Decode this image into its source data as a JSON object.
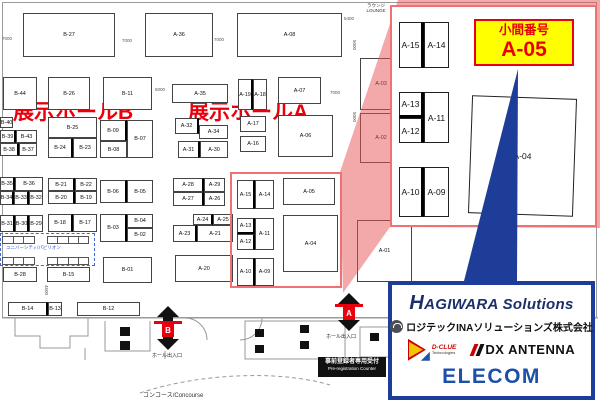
{
  "map": {
    "hall_b_label": "展示ホールB",
    "hall_a_label": "展示ホールA",
    "lounge_line1": "ラウンジ",
    "lounge_line2": "LOUNGE",
    "concourse_label": "コンコース/Concourse",
    "prereg_line1": "事前登録者専用受付",
    "prereg_line2": "Pre-registration Counter",
    "gate_labels": [
      {
        "text": "ホール出入口",
        "x": 152,
        "y": 352
      },
      {
        "text": "ホール出入口",
        "x": 326,
        "y": 333
      }
    ],
    "entrances": [
      {
        "label": "B",
        "x": 157,
        "y": 306,
        "h": 44,
        "bar_y": 321,
        "box_y": 324
      },
      {
        "label": "A",
        "x": 338,
        "y": 293,
        "h": 38,
        "bar_y": 304,
        "box_y": 307
      }
    ],
    "pavilion": {
      "label": "ユニバーシティ/パビリオン",
      "box": {
        "x": 0,
        "y": 233,
        "w": 95,
        "h": 33
      },
      "label_pos": {
        "x": 6,
        "y": 245
      },
      "cell_groups": [
        {
          "x": 2,
          "y": 236,
          "w": 33,
          "h": 8,
          "cells": 3
        },
        {
          "x": 47,
          "y": 236,
          "w": 42,
          "h": 8,
          "cells": 4
        },
        {
          "x": 2,
          "y": 257,
          "w": 33,
          "h": 8,
          "cells": 3
        },
        {
          "x": 47,
          "y": 257,
          "w": 42,
          "h": 8,
          "cells": 4
        }
      ]
    },
    "dimensions": [
      {
        "text": "7000",
        "x": 2,
        "y": 36
      },
      {
        "text": "7000",
        "x": 122,
        "y": 38
      },
      {
        "text": "7000",
        "x": 214,
        "y": 37
      },
      {
        "text": "5400",
        "x": 344,
        "y": 16
      },
      {
        "text": "5000",
        "x": 155,
        "y": 87
      },
      {
        "text": "7000",
        "x": 330,
        "y": 90
      },
      {
        "text": "5000",
        "x": 352,
        "y": 40,
        "v": 1
      },
      {
        "text": "5000",
        "x": 352,
        "y": 112,
        "v": 1
      },
      {
        "text": "4500",
        "x": 44,
        "y": 285,
        "v": 1
      }
    ],
    "booths": [
      {
        "label": "B-27",
        "x": 23,
        "y": 13,
        "w": 92,
        "h": 44
      },
      {
        "label": "A-36",
        "x": 145,
        "y": 13,
        "w": 68,
        "h": 44
      },
      {
        "label": "A-08",
        "x": 237,
        "y": 13,
        "w": 105,
        "h": 44
      },
      {
        "label": "B-44",
        "x": 3,
        "y": 77,
        "w": 34,
        "h": 33
      },
      {
        "label": "B-26",
        "x": 48,
        "y": 77,
        "w": 42,
        "h": 33
      },
      {
        "label": "B-11",
        "x": 103,
        "y": 77,
        "w": 49,
        "h": 33
      },
      {
        "label": "A-35",
        "x": 172,
        "y": 84,
        "w": 56,
        "h": 19
      },
      {
        "label": "A-19",
        "x": 238,
        "y": 79,
        "w": 15,
        "h": 31,
        "wr": 1
      },
      {
        "label": "A-18",
        "x": 253,
        "y": 79,
        "w": 14,
        "h": 31
      },
      {
        "label": "A-07",
        "x": 278,
        "y": 77,
        "w": 43,
        "h": 27
      },
      {
        "label": "A-03",
        "x": 360,
        "y": 58,
        "w": 42,
        "h": 52
      },
      {
        "label": "A-02",
        "x": 360,
        "y": 113,
        "w": 42,
        "h": 50
      },
      {
        "label": "A-01",
        "x": 357,
        "y": 220,
        "w": 55,
        "h": 62
      },
      {
        "label": "B-40",
        "x": 0,
        "y": 117,
        "w": 13,
        "h": 11
      },
      {
        "label": "B-39",
        "x": 0,
        "y": 130,
        "w": 16,
        "h": 13,
        "wr": 1
      },
      {
        "label": "B-43",
        "x": 16,
        "y": 130,
        "w": 21,
        "h": 13
      },
      {
        "label": "B-38",
        "x": 0,
        "y": 143,
        "w": 19,
        "h": 13,
        "wr": 1
      },
      {
        "label": "B-37",
        "x": 19,
        "y": 143,
        "w": 18,
        "h": 13
      },
      {
        "label": "B-25",
        "x": 48,
        "y": 117,
        "w": 49,
        "h": 21
      },
      {
        "label": "B-24",
        "x": 48,
        "y": 138,
        "w": 25,
        "h": 20,
        "wr": 1
      },
      {
        "label": "B-23",
        "x": 73,
        "y": 138,
        "w": 24,
        "h": 20
      },
      {
        "label": "B-09",
        "x": 100,
        "y": 120,
        "w": 27,
        "h": 21,
        "wr": 1
      },
      {
        "label": "B-07",
        "x": 127,
        "y": 120,
        "w": 26,
        "h": 38
      },
      {
        "label": "B-08",
        "x": 100,
        "y": 141,
        "w": 27,
        "h": 17
      },
      {
        "label": "B-35",
        "x": 0,
        "y": 177,
        "w": 15,
        "h": 14,
        "wr": 1
      },
      {
        "label": "B-36",
        "x": 15,
        "y": 177,
        "w": 28,
        "h": 14
      },
      {
        "label": "B-34",
        "x": 0,
        "y": 191,
        "w": 14,
        "h": 14,
        "wr": 1
      },
      {
        "label": "B-33",
        "x": 14,
        "y": 191,
        "w": 15,
        "h": 14,
        "wr": 1
      },
      {
        "label": "B-32",
        "x": 29,
        "y": 191,
        "w": 14,
        "h": 14
      },
      {
        "label": "B-21",
        "x": 48,
        "y": 178,
        "w": 27,
        "h": 13,
        "wr": 1
      },
      {
        "label": "B-22",
        "x": 75,
        "y": 178,
        "w": 22,
        "h": 13
      },
      {
        "label": "B-20",
        "x": 48,
        "y": 191,
        "w": 27,
        "h": 13,
        "wr": 1
      },
      {
        "label": "B-19",
        "x": 75,
        "y": 191,
        "w": 22,
        "h": 13
      },
      {
        "label": "B-06",
        "x": 100,
        "y": 180,
        "w": 27,
        "h": 23,
        "wr": 1
      },
      {
        "label": "B-05",
        "x": 127,
        "y": 180,
        "w": 26,
        "h": 23
      },
      {
        "label": "A-32",
        "x": 175,
        "y": 118,
        "w": 24,
        "h": 16,
        "wr": 1
      },
      {
        "label": "A-34",
        "x": 199,
        "y": 125,
        "w": 29,
        "h": 14
      },
      {
        "label": "A-31",
        "x": 178,
        "y": 141,
        "w": 22,
        "h": 17,
        "wr": 1
      },
      {
        "label": "A-30",
        "x": 200,
        "y": 141,
        "w": 28,
        "h": 17
      },
      {
        "label": "A-17",
        "x": 240,
        "y": 116,
        "w": 26,
        "h": 16
      },
      {
        "label": "A-16",
        "x": 240,
        "y": 136,
        "w": 26,
        "h": 16
      },
      {
        "label": "A-06",
        "x": 278,
        "y": 115,
        "w": 55,
        "h": 42
      },
      {
        "label": "A-28",
        "x": 173,
        "y": 178,
        "w": 31,
        "h": 14,
        "wr": 1
      },
      {
        "label": "A-29",
        "x": 204,
        "y": 178,
        "w": 21,
        "h": 14
      },
      {
        "label": "A-27",
        "x": 173,
        "y": 192,
        "w": 31,
        "h": 14,
        "wr": 1
      },
      {
        "label": "A-26",
        "x": 204,
        "y": 192,
        "w": 21,
        "h": 14
      },
      {
        "label": "B-31",
        "x": 0,
        "y": 215,
        "w": 15,
        "h": 17,
        "wr": 1
      },
      {
        "label": "B-30",
        "x": 15,
        "y": 215,
        "w": 14,
        "h": 17,
        "wr": 1
      },
      {
        "label": "B-29",
        "x": 29,
        "y": 215,
        "w": 14,
        "h": 17
      },
      {
        "label": "B-18",
        "x": 48,
        "y": 214,
        "w": 25,
        "h": 18,
        "wr": 1
      },
      {
        "label": "B-17",
        "x": 73,
        "y": 214,
        "w": 24,
        "h": 18
      },
      {
        "label": "B-03",
        "x": 100,
        "y": 214,
        "w": 27,
        "h": 28,
        "wr": 1
      },
      {
        "label": "B-04",
        "x": 127,
        "y": 214,
        "w": 26,
        "h": 14
      },
      {
        "label": "B-02",
        "x": 127,
        "y": 228,
        "w": 26,
        "h": 14
      },
      {
        "label": "A-24",
        "x": 193,
        "y": 214,
        "w": 20,
        "h": 11,
        "wr": 1
      },
      {
        "label": "A-25",
        "x": 213,
        "y": 214,
        "w": 20,
        "h": 11
      },
      {
        "label": "A-23",
        "x": 173,
        "y": 225,
        "w": 24,
        "h": 17,
        "wr": 1
      },
      {
        "label": "A-21",
        "x": 197,
        "y": 225,
        "w": 36,
        "h": 17
      },
      {
        "label": "A-20",
        "x": 175,
        "y": 255,
        "w": 58,
        "h": 27
      },
      {
        "label": "B-01",
        "x": 103,
        "y": 257,
        "w": 49,
        "h": 26
      },
      {
        "label": "B-28",
        "x": 3,
        "y": 267,
        "w": 34,
        "h": 15
      },
      {
        "label": "B-15",
        "x": 47,
        "y": 267,
        "w": 43,
        "h": 15
      },
      {
        "label": "B-14",
        "x": 8,
        "y": 302,
        "w": 40,
        "h": 14,
        "wr": 1
      },
      {
        "label": "B-13",
        "x": 48,
        "y": 302,
        "w": 14,
        "h": 14
      },
      {
        "label": "B-12",
        "x": 77,
        "y": 302,
        "w": 63,
        "h": 14
      },
      {
        "label": "A-15",
        "x": 237,
        "y": 180,
        "w": 18,
        "h": 29,
        "wr": 1
      },
      {
        "label": "A-14",
        "x": 255,
        "y": 180,
        "w": 19,
        "h": 29
      },
      {
        "label": "A-05",
        "x": 283,
        "y": 178,
        "w": 52,
        "h": 27
      },
      {
        "label": "A-13",
        "x": 237,
        "y": 218,
        "w": 18,
        "h": 16,
        "wr": 1,
        "wb": 1
      },
      {
        "label": "A-11",
        "x": 255,
        "y": 218,
        "w": 19,
        "h": 32
      },
      {
        "label": "A-12",
        "x": 237,
        "y": 234,
        "w": 18,
        "h": 16,
        "wr": 1
      },
      {
        "label": "A-04",
        "x": 283,
        "y": 215,
        "w": 55,
        "h": 57
      },
      {
        "label": "A-10",
        "x": 237,
        "y": 258,
        "w": 18,
        "h": 28,
        "wr": 1
      },
      {
        "label": "A-09",
        "x": 255,
        "y": 258,
        "w": 19,
        "h": 28
      }
    ]
  },
  "inset": {
    "callout": {
      "title": "小間番号",
      "booth": "A-05"
    },
    "booths": [
      {
        "label": "A-15",
        "x": 399,
        "y": 22,
        "w": 25,
        "h": 46,
        "wr": 1
      },
      {
        "label": "A-14",
        "x": 424,
        "y": 22,
        "w": 25,
        "h": 46
      },
      {
        "label": "A-13",
        "x": 399,
        "y": 92,
        "w": 25,
        "h": 26,
        "wr": 1,
        "wb": 1
      },
      {
        "label": "A-11",
        "x": 424,
        "y": 92,
        "w": 25,
        "h": 51
      },
      {
        "label": "A-12",
        "x": 399,
        "y": 118,
        "w": 25,
        "h": 25,
        "wr": 1
      },
      {
        "label": "A-10",
        "x": 399,
        "y": 167,
        "w": 25,
        "h": 50,
        "wr": 1
      },
      {
        "label": "A-09",
        "x": 424,
        "y": 167,
        "w": 25,
        "h": 50
      },
      {
        "label": "A-04",
        "x": 470,
        "y": 97,
        "w": 105,
        "h": 118,
        "rot": 2
      }
    ]
  },
  "logos": {
    "hagiwara": "HAGIWARA Solutions",
    "logitec": "ロジテックINAソリューションズ株式会社",
    "dclue_line1": "D-CLUE",
    "dclue_line2": "Technologies",
    "dx_antenna": "DX ANTENNA",
    "elecom": "ELECOM"
  },
  "colors": {
    "accent_red": "#e8000d",
    "overlay_red": "rgba(232,84,84,0.5)",
    "callout_bg": "#ffff00",
    "frame_red": "#ee7272",
    "brand_blue": "#1d3d99",
    "hagiwara_navy": "#1c2f68",
    "elecom_blue": "#1b4fa8",
    "dx_red": "#cc0000",
    "dclue_yellow": "#f5c400"
  }
}
